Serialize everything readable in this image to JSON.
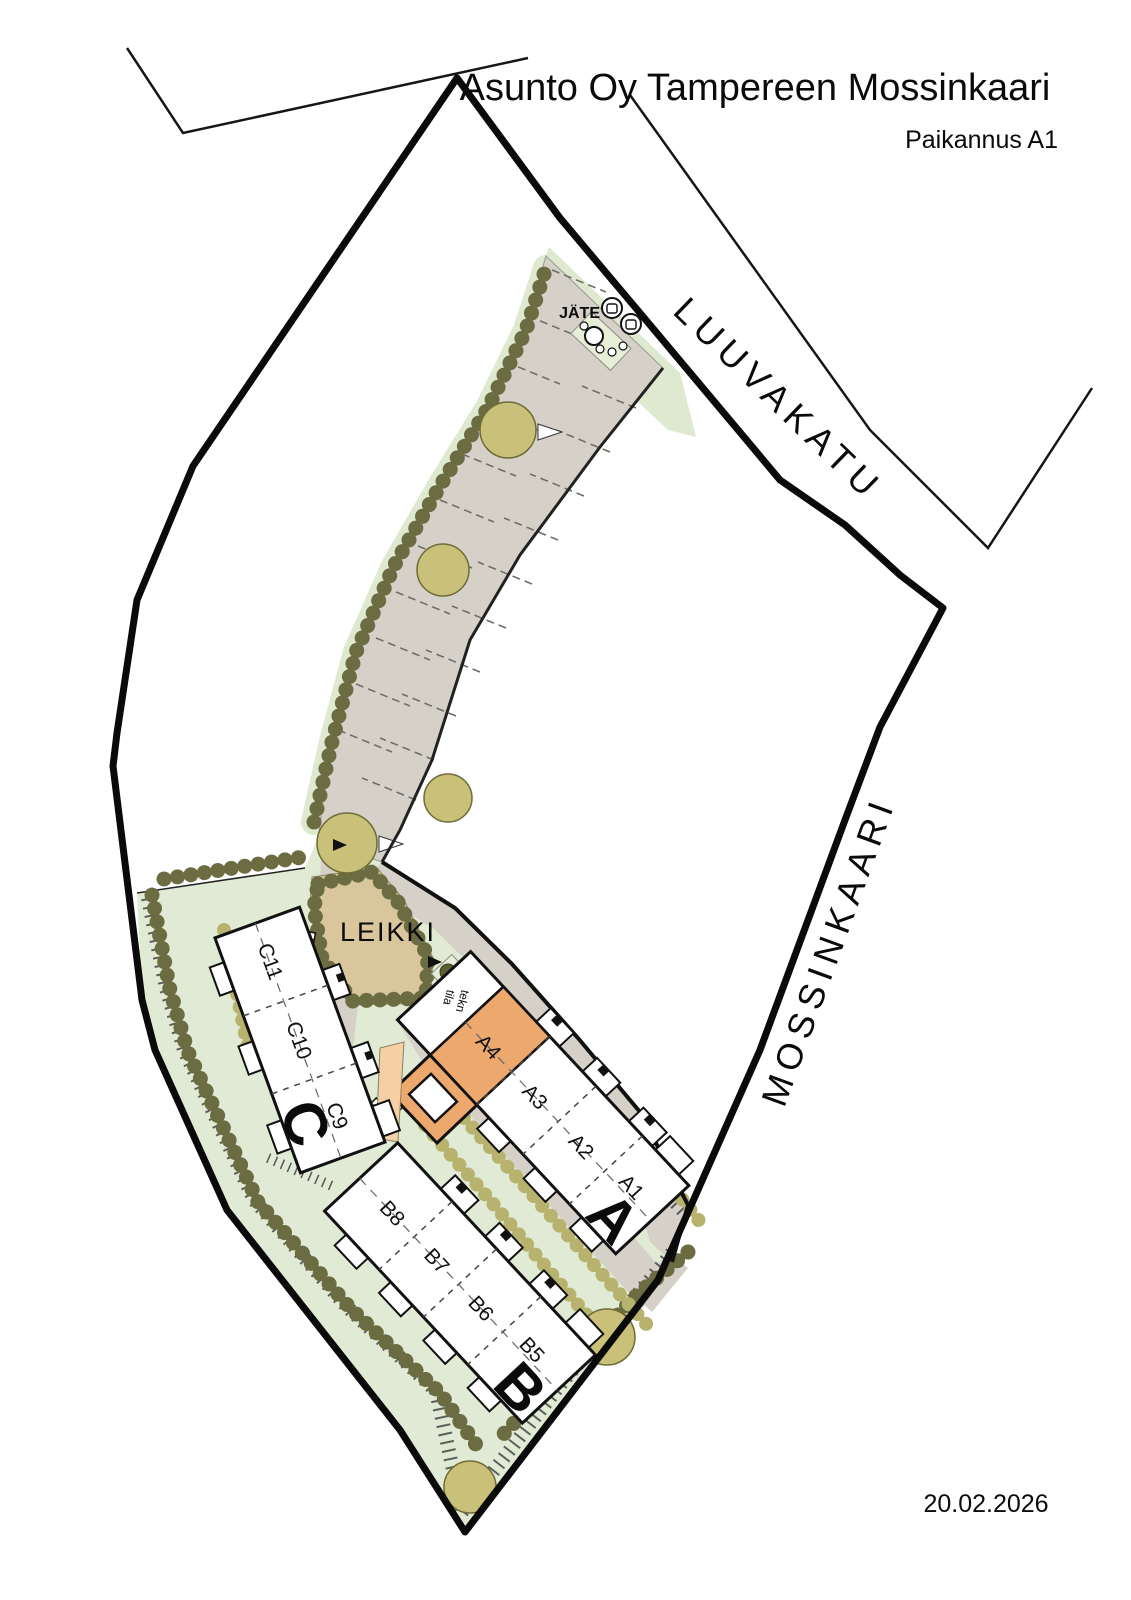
{
  "header": {
    "title": "Asunto Oy Tampereen Mossinkaari",
    "subtitle": "Paikannus A1"
  },
  "footer": {
    "date": "20.02.2026"
  },
  "streets": {
    "north": "LUUVAKATU",
    "east": "MOSSINKAARI"
  },
  "site": {
    "play_area": "LEIKKI",
    "waste_point": "JÄTE",
    "tech_room": {
      "line1": "tekn",
      "line2": "tila"
    }
  },
  "buildings": [
    {
      "letter": "A",
      "units": [
        "A4",
        "A3",
        "A2",
        "A1"
      ],
      "highlighted_unit": "A4"
    },
    {
      "letter": "B",
      "units": [
        "B8",
        "B7",
        "B6",
        "B5"
      ]
    },
    {
      "letter": "C",
      "units": [
        "C11",
        "C10",
        "C9"
      ]
    }
  ],
  "colors": {
    "unit_highlight": "#eda86e",
    "yard_highlight": "#eda86e",
    "yard_highlight_light": "#f5d0a5",
    "pavement": "#d5d1c8",
    "lawn": "#e1ead4",
    "strip_green": "#dfe9d0",
    "play_sand": "#d9c69c",
    "tree_green": "#c9c17a",
    "hedge_dark": "#6b6c41",
    "hedge_light": "#b7b26d"
  }
}
